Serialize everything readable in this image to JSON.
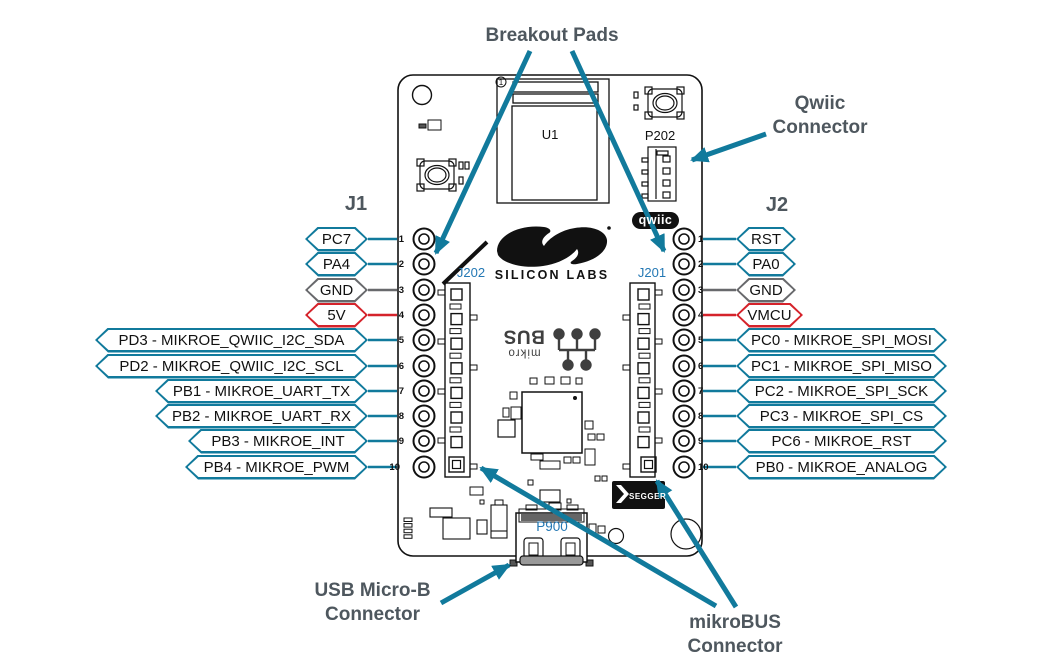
{
  "palette": {
    "teal_accent": "#117A9C",
    "power_red": "#D5232B",
    "ground_gray": "#68696C",
    "annotation_slate": "#4E575E",
    "refdes_blue": "#2478B4",
    "line_black": "#111111"
  },
  "annotations": {
    "breakout_pads": "Breakout Pads",
    "qwiic_connector_line1": "Qwiic",
    "qwiic_connector_line2": "Connector",
    "usb_connector_line1": "USB Micro-B",
    "usb_connector_line2": "Connector",
    "mikrobus_connector_line1": "mikroBUS",
    "mikrobus_connector_line2": "Connector"
  },
  "board": {
    "module_refdes": "U1",
    "module_pin1_marker": "1",
    "qwiic_connector_refdes": "P202",
    "qwiic_logo": "qwiic",
    "silicon_labs_logo_text": "SILICON LABS",
    "mikrobus_socket_left_refdes": "J202",
    "mikrobus_socket_right_refdes": "J201",
    "usb_connector_refdes": "P900",
    "segger_logo_text": "SEGGER",
    "mikrobus_logo_line1": "mikro",
    "mikrobus_logo_line2": "BUS"
  },
  "j1": {
    "title": "J1",
    "pins": [
      {
        "num": "1",
        "label": "PC7",
        "type": "signal"
      },
      {
        "num": "2",
        "label": "PA4",
        "type": "signal"
      },
      {
        "num": "3",
        "label": "GND",
        "type": "ground"
      },
      {
        "num": "4",
        "label": "5V",
        "type": "power"
      },
      {
        "num": "5",
        "label": "PD3 - MIKROE_QWIIC_I2C_SDA",
        "type": "signal"
      },
      {
        "num": "6",
        "label": "PD2 - MIKROE_QWIIC_I2C_SCL",
        "type": "signal"
      },
      {
        "num": "7",
        "label": "PB1 - MIKROE_UART_TX",
        "type": "signal"
      },
      {
        "num": "8",
        "label": "PB2 - MIKROE_UART_RX",
        "type": "signal"
      },
      {
        "num": "9",
        "label": "PB3 - MIKROE_INT",
        "type": "signal"
      },
      {
        "num": "10",
        "label": "PB4 - MIKROE_PWM",
        "type": "signal"
      }
    ]
  },
  "j2": {
    "title": "J2",
    "pins": [
      {
        "num": "1",
        "label": "RST",
        "type": "signal"
      },
      {
        "num": "2",
        "label": "PA0",
        "type": "signal"
      },
      {
        "num": "3",
        "label": "GND",
        "type": "ground"
      },
      {
        "num": "4",
        "label": "VMCU",
        "type": "power"
      },
      {
        "num": "5",
        "label": "PC0 - MIKROE_SPI_MOSI",
        "type": "signal"
      },
      {
        "num": "6",
        "label": "PC1 - MIKROE_SPI_MISO",
        "type": "signal"
      },
      {
        "num": "7",
        "label": "PC2 - MIKROE_SPI_SCK",
        "type": "signal"
      },
      {
        "num": "8",
        "label": "PC3 - MIKROE_SPI_CS",
        "type": "signal"
      },
      {
        "num": "9",
        "label": "PC6 - MIKROE_RST",
        "type": "signal"
      },
      {
        "num": "10",
        "label": "PB0 - MIKROE_ANALOG",
        "type": "signal"
      }
    ]
  }
}
